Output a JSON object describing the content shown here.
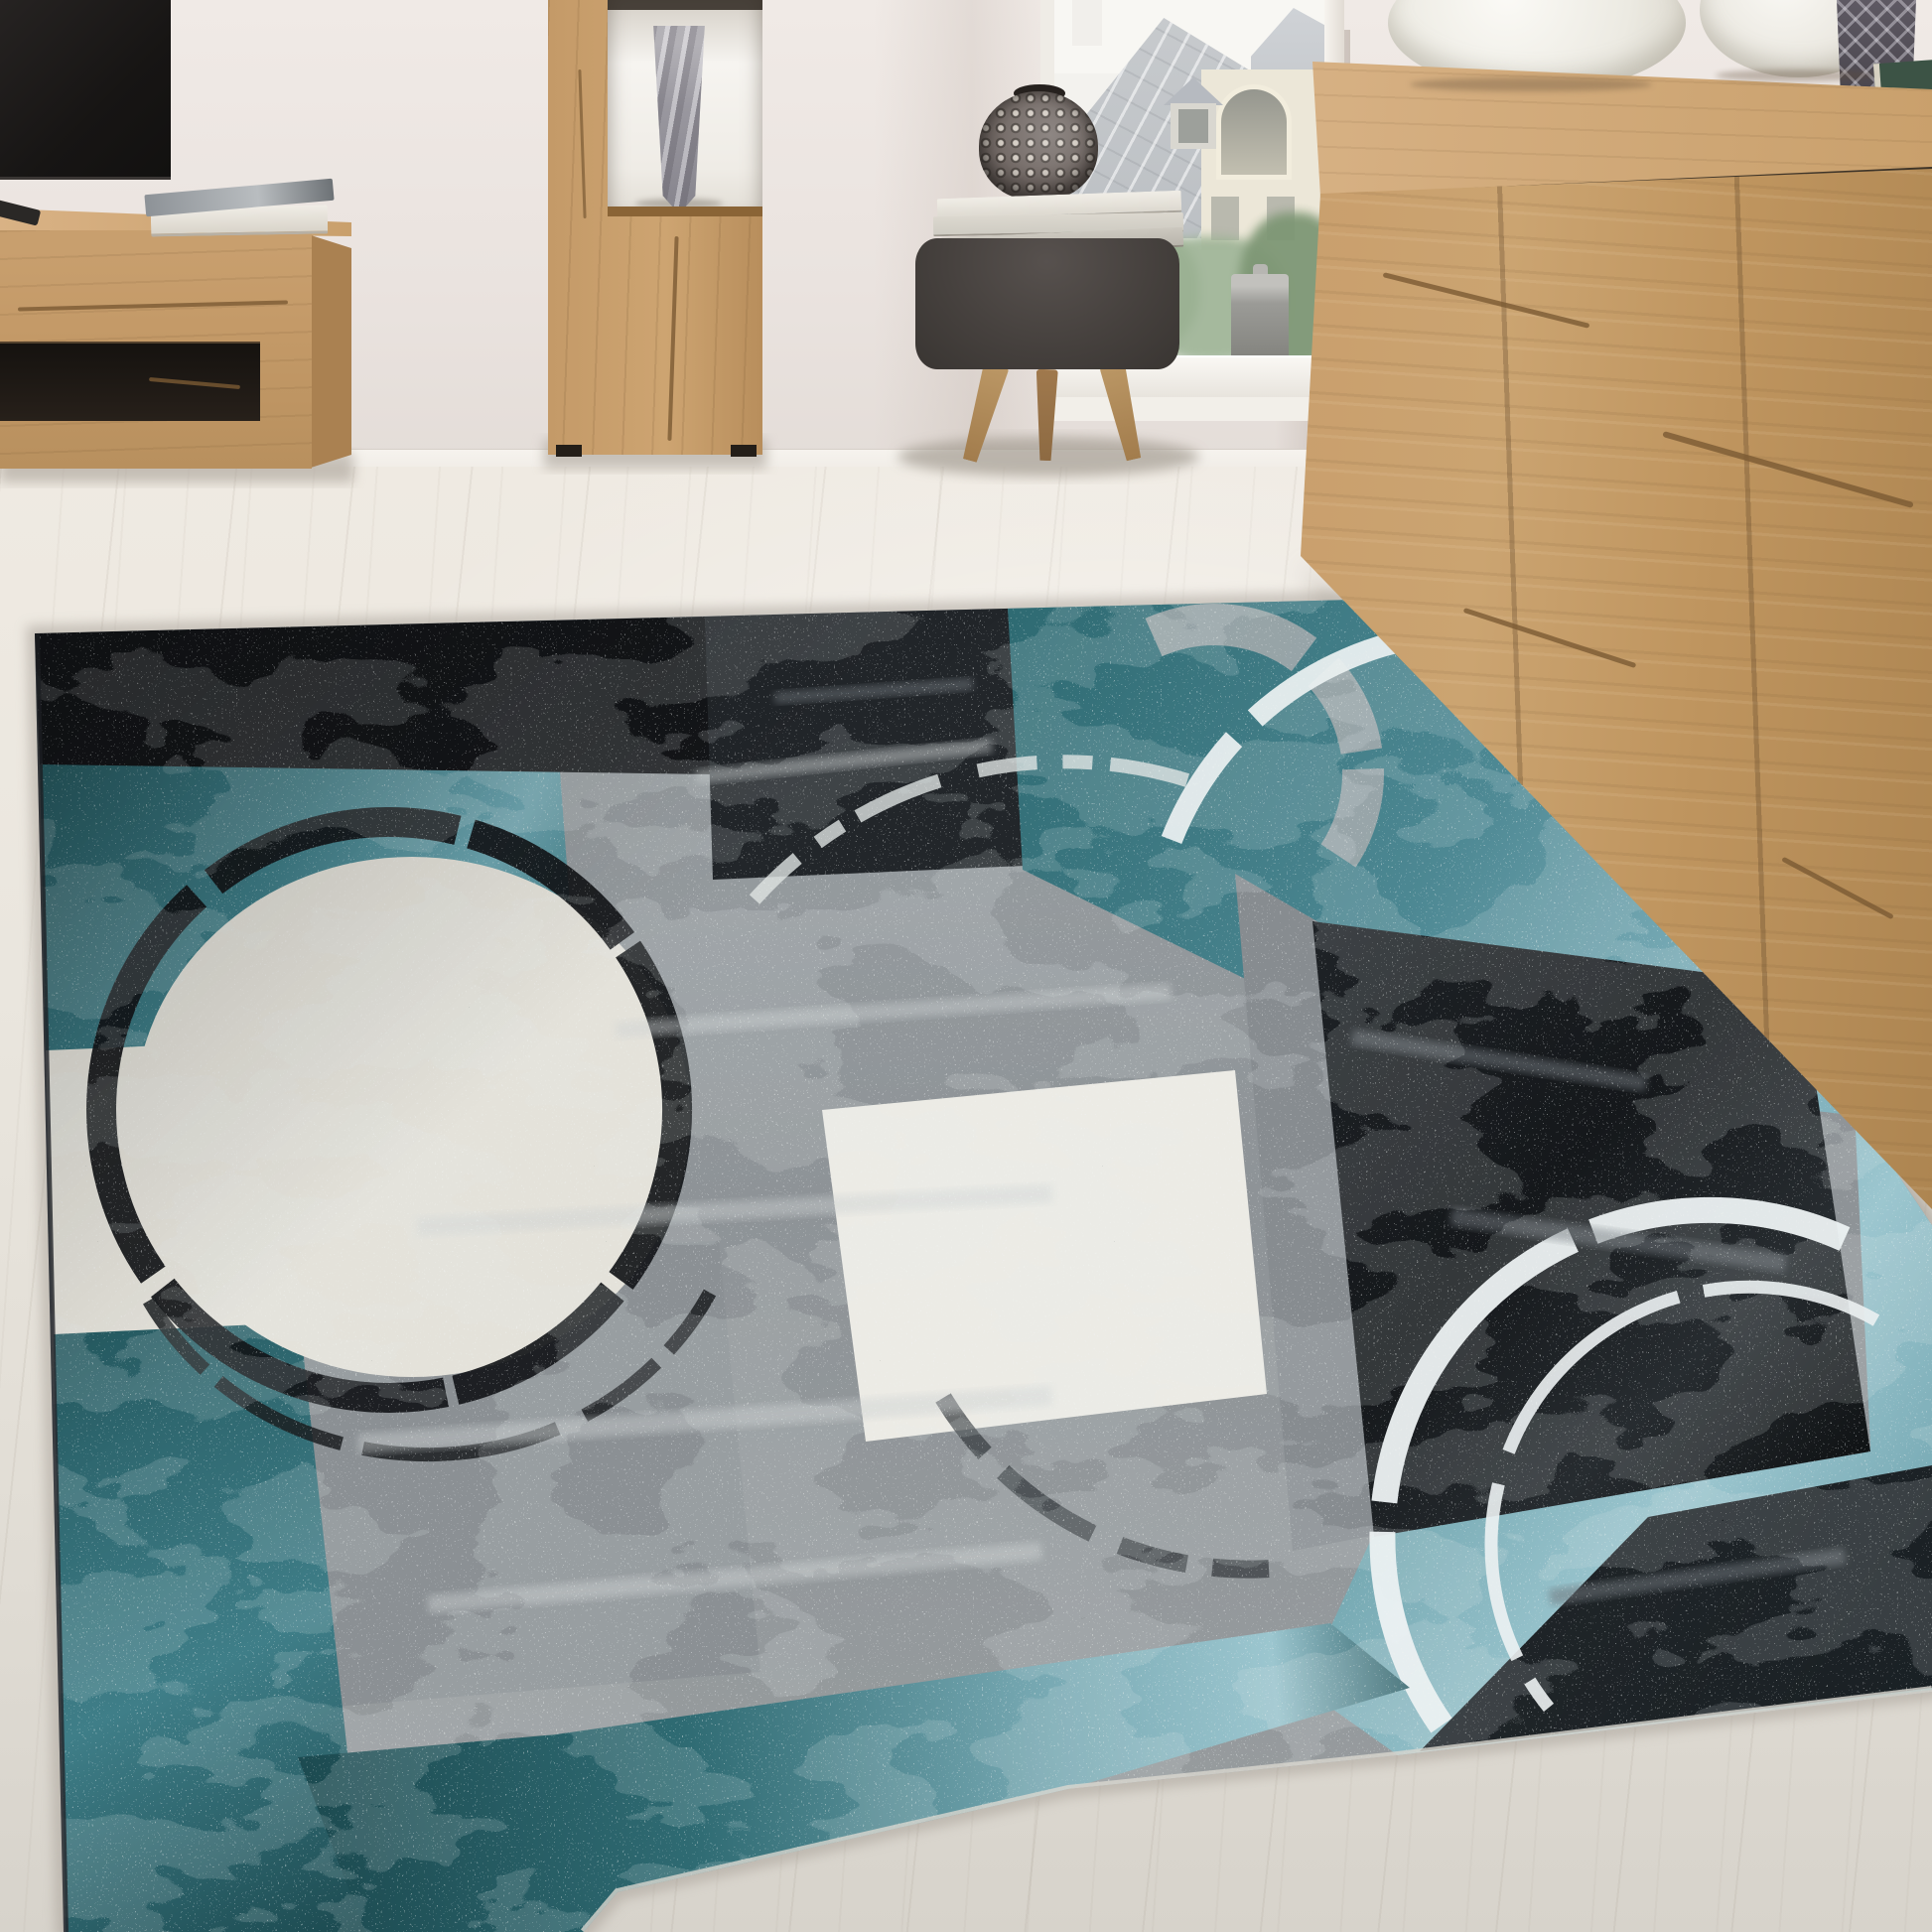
{
  "scene": {
    "title": "Living room with an abstract distressed patchwork rug in turquoise, grey, black and cream, light oak furniture and a window with a city rooftop view",
    "room": {
      "wall": "blush-white wall",
      "floor": "whitewashed light wood floorboards",
      "window_view": [
        "slate mansard rooftop",
        "dormer window",
        "cream facade with arched window",
        "green trees"
      ],
      "window_sill_item": "grey cylindrical pot"
    },
    "furniture": [
      {
        "name": "tv-lowboard",
        "material": "rustic light oak",
        "items_on_top": [
          "flat tv",
          "stack of books",
          "magazine",
          "remote control"
        ]
      },
      {
        "name": "display-cabinet",
        "material": "rustic light oak",
        "items": [
          "cut-crystal vase in lit niche"
        ]
      },
      {
        "name": "stool",
        "material": "dark grey fabric, wooden legs",
        "items_on_top": [
          "stack of magazines",
          "pineapple-shaped vase"
        ]
      },
      {
        "name": "sideboard",
        "material": "rustic light oak with cracks",
        "items_on_top": [
          "two white bowls",
          "cut-crystal vase",
          "stacked green books"
        ]
      }
    ],
    "rug": {
      "style": "abstract distressed patchwork",
      "patches": [
        "black",
        "charcoal",
        "teal",
        "grey",
        "cream"
      ],
      "motifs": [
        "black sketched ring around cream circle",
        "white ring arc top right",
        "double white ring bottom right",
        "grey corner ring",
        "dark arc fragment bottom centre"
      ]
    }
  },
  "colors": {
    "wall": "#eae3df",
    "wall-hi": "#f0eae6",
    "wall-lo": "#e2dbd6",
    "baseboard": "#f6f3ee",
    "floor-hi": "#efeae2",
    "floor": "#eae6de",
    "floor-lo": "#e1ddd5",
    "floor-deep": "#d7d3cb",
    "oak": "#c49a68",
    "grain": "#7a5a33",
    "niche": "#f6f4f0",
    "crystal": "#97959c",
    "stool": "#46413e",
    "leg": "#a27c4c",
    "pineapple": "#756c68",
    "bowl": "#eceae2",
    "book-green": "#3c5345",
    "sky": "#f3f2ee",
    "roof": "#c7cacd",
    "facade": "#ece7d8",
    "leaf": "#87a07e",
    "leaf-dark": "#7e9775",
    "canister": "#9b9b97",
    "sill": "#f2efe9",
    "rug-gray": "#909599",
    "rug-gray-hi": "#ced2d3",
    "rug-gray-dk": "#70767b",
    "rug-black": "#141619",
    "rug-charcoal": "#22262a",
    "rug-teal": "#3f7e88",
    "rug-teal-dk": "#1c4a50",
    "rug-teal-lt": "#9cc6cf",
    "rug-cream": "#e4e2da",
    "rug-white": "#ecebe5",
    "ring-white": "#edf2f3"
  }
}
